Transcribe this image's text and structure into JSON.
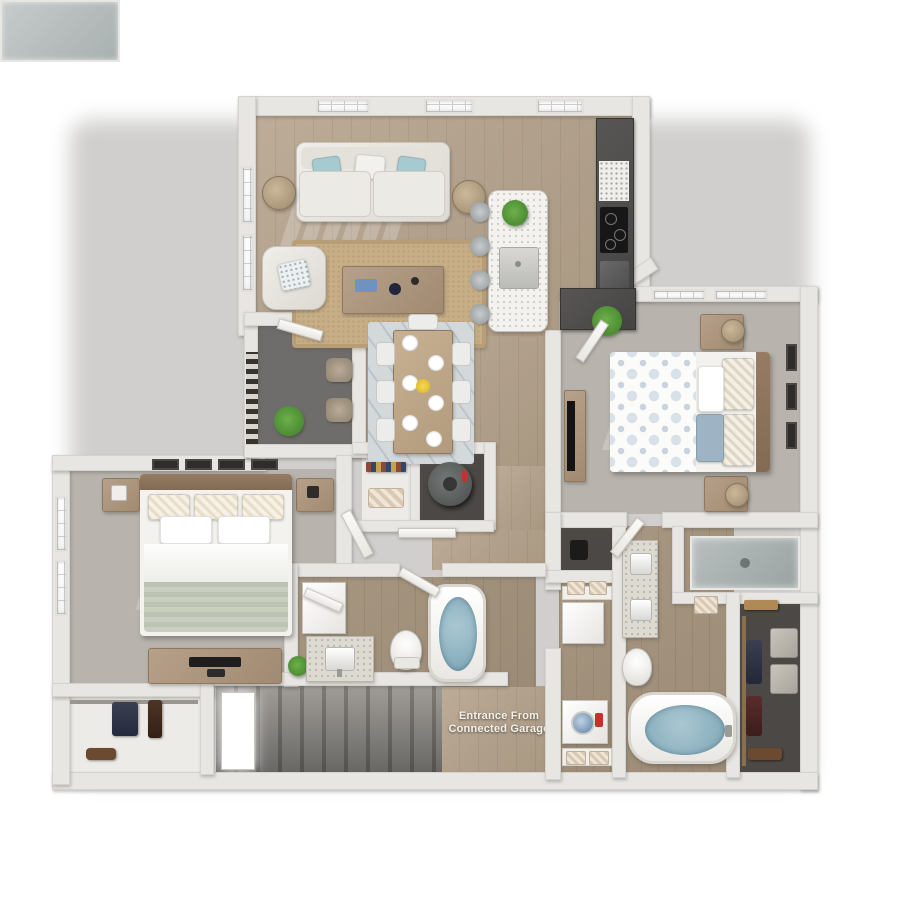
{
  "scene": {
    "description": "3D top-down rendering of a two-bedroom, two-bathroom apartment floor plan with living room, kitchen island, dining area, den, laundry, walk-in closet and a staircase down to a connected garage",
    "background": "#ffffff"
  },
  "labels": {
    "entrance": {
      "line1": "Entrance From",
      "line2": "Connected Garage",
      "color": "#f4f1ea"
    }
  },
  "palette": {
    "wall": "#e8e6e2",
    "wall_shadow": "#c9c6c1",
    "wood_floor": "#b2a18d",
    "wood_floor_dark": "#9b8b76",
    "carpet": "#b8b3ad",
    "den_floor": "#6f6d6b",
    "closet_floor": "#4c4845",
    "cabinet_dark": "#4e4d4c",
    "counter_white": "#f3f2ef",
    "tub_water_blue": "#8fb6c6",
    "accent_teal": "#a5cbd1",
    "jute_rug": "#c7ae86",
    "dining_rug": "#ccd3d8",
    "plant_green": "#4e9d3b",
    "blanket_sage": "#c3c9bb",
    "furniture_wood": "#ab947c",
    "stair_gray": "#8a8783",
    "tv_black": "#1e1e1e",
    "detergent_red": "#c3322b",
    "flower_yellow": "#e8c832"
  },
  "rooms": [
    {
      "name": "living-room"
    },
    {
      "name": "kitchen"
    },
    {
      "name": "dining-area"
    },
    {
      "name": "den-patio"
    },
    {
      "name": "hallway"
    },
    {
      "name": "master-bedroom"
    },
    {
      "name": "bedroom-2"
    },
    {
      "name": "master-bathroom"
    },
    {
      "name": "second-bathroom"
    },
    {
      "name": "walk-in-closet"
    },
    {
      "name": "laundry-closet"
    },
    {
      "name": "entry-closet"
    },
    {
      "name": "water-heater-closet"
    },
    {
      "name": "staircase-to-garage"
    }
  ]
}
